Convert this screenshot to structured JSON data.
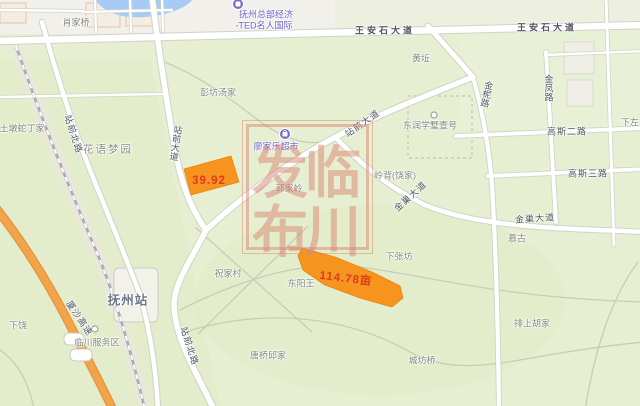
{
  "map": {
    "colors": {
      "bg": "#e6efd2",
      "urban": "#f1f0ea",
      "urban_right": "#edf0df",
      "patch": "#dfebc2",
      "water": "#a6cbf5",
      "road_fill": "#ffffff",
      "road_casing": "#d2d2c8",
      "minor_road": "#c9ccb9",
      "railway": "#a9afb5",
      "highway": "#f2a44a",
      "highway_casing": "#e18f33",
      "parcel": "#f7941e",
      "parcel_stroke": "#ea830f",
      "parcel_text": "#dc3b20",
      "poi_purple": "#7b68c9",
      "watermark": "#d98a76"
    },
    "watermark": {
      "text": "临川发布",
      "frame": {
        "x": 242,
        "y": 120,
        "w": 129,
        "h": 132
      },
      "chars": [
        {
          "name": "watermark-char-lin",
          "text": "临",
          "x": 333,
          "y": 169,
          "type": "wm"
        },
        {
          "name": "watermark-char-chuan",
          "text": "川",
          "x": 333,
          "y": 228,
          "type": "wm"
        },
        {
          "name": "watermark-char-fa",
          "text": "发",
          "x": 280,
          "y": 169,
          "type": "wm"
        },
        {
          "name": "watermark-char-bu",
          "text": "布",
          "x": 280,
          "y": 228,
          "type": "wm"
        }
      ]
    },
    "parcels": [
      {
        "name": "parcel-1",
        "area_label": "39.92"
      },
      {
        "name": "parcel-2",
        "area_label": "114.78亩"
      }
    ],
    "labels": [
      {
        "name": "label-xiaojiaqiao",
        "text": "肖家桥",
        "x": 76,
        "y": 22,
        "type": "place"
      },
      {
        "name": "label-fuzhou-hq-line1",
        "text": "抚州总部经济",
        "x": 266,
        "y": 14,
        "type": "poi"
      },
      {
        "name": "label-fuzhou-hq-line2",
        "text": "-TED名人国际",
        "x": 264,
        "y": 25,
        "type": "poi"
      },
      {
        "name": "label-wanganshi-avenue-1",
        "text": "王安石大道",
        "x": 385,
        "y": 30,
        "type": "roadwide"
      },
      {
        "name": "label-wanganshi-avenue-2",
        "text": "王安石大道",
        "x": 547,
        "y": 27,
        "type": "roadwide"
      },
      {
        "name": "label-huangqiu",
        "text": "黄坵",
        "x": 421,
        "y": 58,
        "type": "place"
      },
      {
        "name": "label-pengfang-tangjia",
        "text": "彭坊汤家",
        "x": 218,
        "y": 92,
        "type": "place"
      },
      {
        "name": "label-jinni-road",
        "text": "金柅路",
        "x": 487,
        "y": 94,
        "type": "roadv",
        "rot": 12
      },
      {
        "name": "label-jinfeng-road",
        "text": "金凤路",
        "x": 549,
        "y": 88,
        "type": "roadv"
      },
      {
        "name": "label-xiazuo",
        "text": "下左",
        "x": 630,
        "y": 122,
        "type": "place"
      },
      {
        "name": "label-gaosi-2nd-road",
        "text": "高斯二路",
        "x": 567,
        "y": 131,
        "type": "road"
      },
      {
        "name": "label-gaosi-3rd-road",
        "text": "高斯三路",
        "x": 588,
        "y": 173,
        "type": "road"
      },
      {
        "name": "label-dongrun",
        "text": "东润学墅壹号",
        "x": 430,
        "y": 125,
        "type": "place"
      },
      {
        "name": "label-zhanqian-avenue-vertical",
        "text": "站前大道",
        "x": 176,
        "y": 143,
        "type": "roadv",
        "rot": 8
      },
      {
        "name": "label-zhanqian-avenue-diagonal",
        "text": "站前大道",
        "x": 362,
        "y": 123,
        "type": "road",
        "rot": -35
      },
      {
        "name": "label-zhanqian-north-road-1",
        "text": "站前北路",
        "x": 74,
        "y": 134,
        "type": "road",
        "rot": 72
      },
      {
        "name": "label-zhanqian-north-road-2",
        "text": "站前北路",
        "x": 190,
        "y": 346,
        "type": "road",
        "rot": 72
      },
      {
        "name": "label-tudun-shedingjia",
        "text": "土墩蛇丁家",
        "x": 22,
        "y": 128,
        "type": "place"
      },
      {
        "name": "label-huayu-mengyuan",
        "text": "花语梦园",
        "x": 108,
        "y": 149,
        "type": "area"
      },
      {
        "name": "label-lingbei-raojia",
        "text": "岭背(饶家)",
        "x": 395,
        "y": 175,
        "type": "place"
      },
      {
        "name": "label-guojialing",
        "text": "郭家岭",
        "x": 289,
        "y": 188,
        "type": "place"
      },
      {
        "name": "label-jinchao-avenue-1",
        "text": "金巢大道",
        "x": 410,
        "y": 196,
        "type": "road",
        "rot": -42
      },
      {
        "name": "label-jinchao-avenue-2",
        "text": "金巢大道",
        "x": 535,
        "y": 218,
        "type": "road",
        "rot": -4
      },
      {
        "name": "label-xiazhangfang",
        "text": "下张坊",
        "x": 399,
        "y": 256,
        "type": "place"
      },
      {
        "name": "label-mugu",
        "text": "慕古",
        "x": 517,
        "y": 238,
        "type": "place"
      },
      {
        "name": "label-zhujiacun",
        "text": "祝家村",
        "x": 228,
        "y": 273,
        "type": "place"
      },
      {
        "name": "label-dongyangwang",
        "text": "东阳王",
        "x": 301,
        "y": 283,
        "type": "place"
      },
      {
        "name": "label-paishang-hujia",
        "text": "排上胡家",
        "x": 532,
        "y": 323,
        "type": "place"
      },
      {
        "name": "label-chengfangqiao",
        "text": "城坊桥",
        "x": 422,
        "y": 360,
        "type": "place"
      },
      {
        "name": "label-tangqiao-qiujia",
        "text": "唐桥邱家",
        "x": 268,
        "y": 355,
        "type": "place"
      },
      {
        "name": "label-xiarao",
        "text": "下饶",
        "x": 18,
        "y": 325,
        "type": "place"
      },
      {
        "name": "label-fuzhou-station",
        "text": "抚州站",
        "x": 128,
        "y": 299,
        "type": "station"
      },
      {
        "name": "label-linchuan-service-area",
        "text": "临川服务区",
        "x": 97,
        "y": 342,
        "type": "place"
      },
      {
        "name": "label-xiasha-expressway",
        "text": "厦沙高速",
        "x": 80,
        "y": 318,
        "type": "road",
        "rot": 56
      },
      {
        "name": "label-supermarket",
        "text": "廖家乐超市",
        "x": 276,
        "y": 146,
        "type": "poi"
      },
      {
        "name": "parcel-label-1",
        "text": "39.92",
        "x": 209,
        "y": 181,
        "type": "parcel-lbl"
      },
      {
        "name": "parcel-label-2",
        "text": "114.78亩",
        "x": 346,
        "y": 278,
        "type": "parcel-lbl",
        "rot": 7
      }
    ]
  }
}
